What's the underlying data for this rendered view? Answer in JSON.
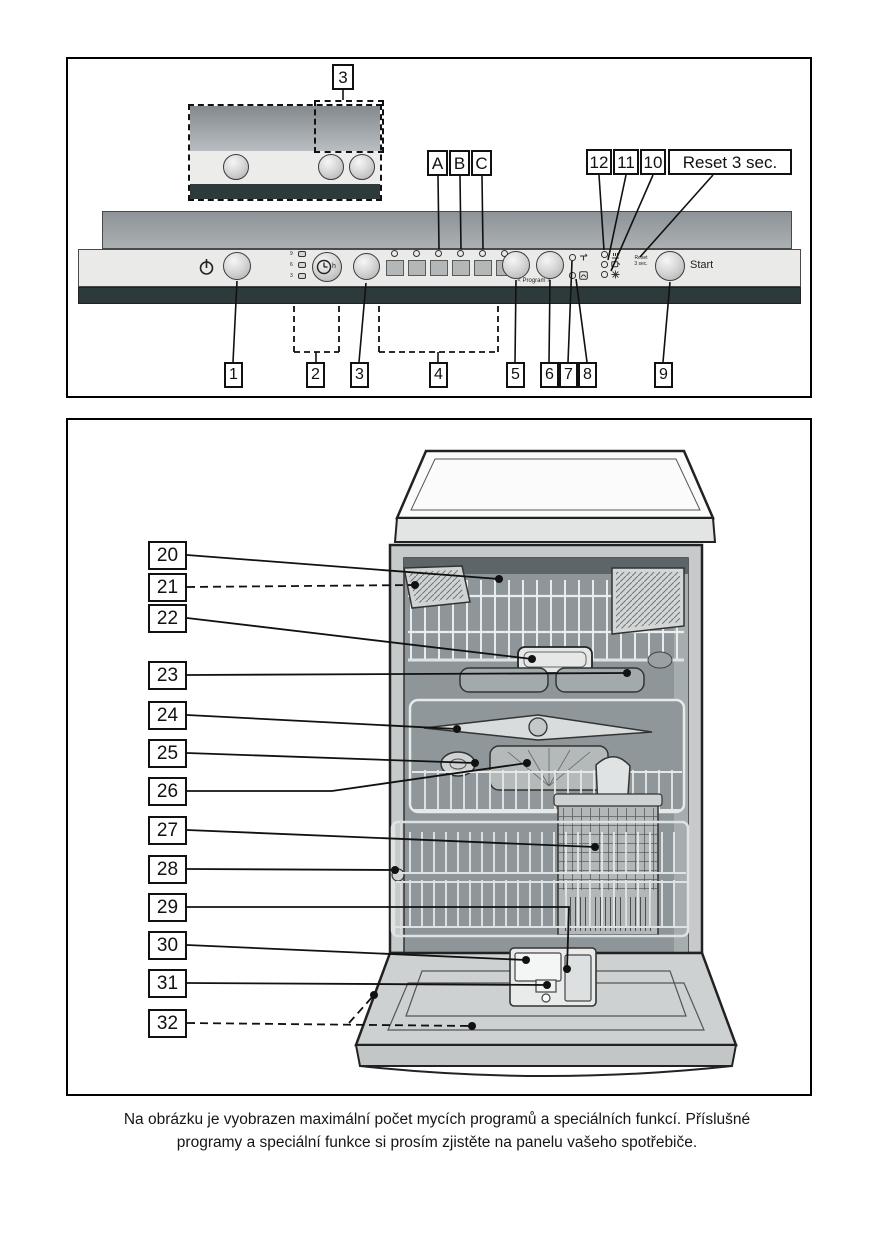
{
  "figure1": {
    "inset_callout": "3",
    "top_callouts": [
      "A",
      "B",
      "C"
    ],
    "indicator_callouts": [
      "12",
      "11",
      "10"
    ],
    "reset_callout": "Reset 3 sec.",
    "bottom_callouts": [
      "1",
      "2",
      "3",
      "4",
      "5",
      "6",
      "7",
      "8",
      "9"
    ],
    "panel": {
      "delay_hours": [
        "9",
        "6",
        "3"
      ],
      "timer_unit": "h",
      "program_nav_label": "< Program >",
      "start_label": "Start",
      "reset_hint_line1": "Reset",
      "reset_hint_line2": "3 sec."
    }
  },
  "figure2": {
    "callouts": [
      "20",
      "21",
      "22",
      "23",
      "24",
      "25",
      "26",
      "27",
      "28",
      "29",
      "30",
      "31",
      "32"
    ]
  },
  "caption": {
    "line1": "Na obrázku je vyobrazen maximální počet mycích programů a speciálních funkcí. Příslušné",
    "line2": "programy a speciální funkce si prosím zjistěte na panelu vašeho spotřebiče."
  }
}
